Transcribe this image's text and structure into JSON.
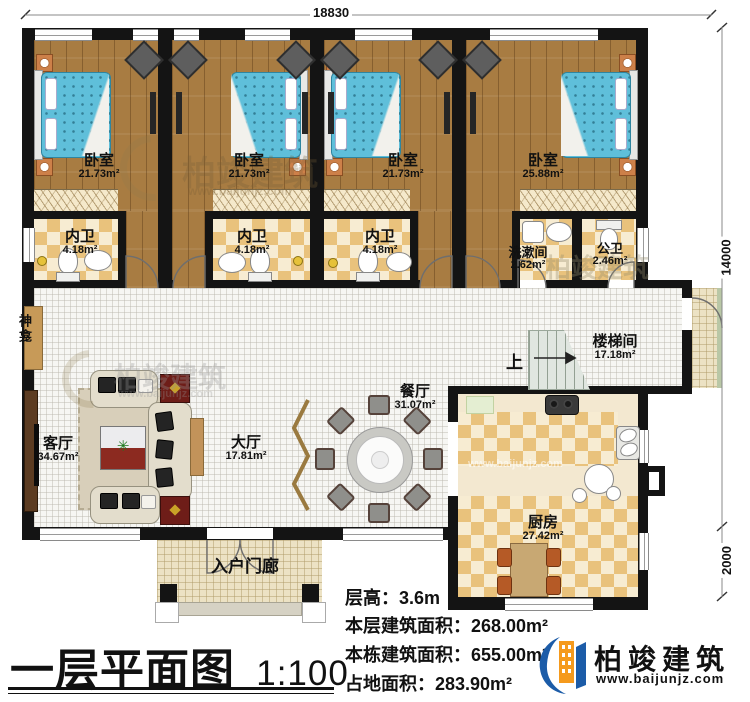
{
  "meta": {
    "title": "一层平面图",
    "scale": "1:100"
  },
  "dimensions": {
    "top_width": "18830",
    "right_height": "14000",
    "right_lower": "2000"
  },
  "rooms": [
    {
      "id": "bedroom1",
      "name": "卧室",
      "area": "21.73m²"
    },
    {
      "id": "bedroom2",
      "name": "卧室",
      "area": "21.73m²"
    },
    {
      "id": "bedroom3",
      "name": "卧室",
      "area": "21.73m²"
    },
    {
      "id": "bedroom4",
      "name": "卧室",
      "area": "25.88m²"
    },
    {
      "id": "ensuite1",
      "name": "内卫",
      "area": "4.18m²"
    },
    {
      "id": "ensuite2",
      "name": "内卫",
      "area": "4.18m²"
    },
    {
      "id": "ensuite3",
      "name": "内卫",
      "area": "4.18m²"
    },
    {
      "id": "washroom",
      "name": "洗漱间",
      "area": "2.62m²"
    },
    {
      "id": "public-bath",
      "name": "公卫",
      "area": "2.46m²"
    },
    {
      "id": "stairwell",
      "name": "楼梯间",
      "area": "17.18m²"
    },
    {
      "id": "dining",
      "name": "餐厅",
      "area": "31.07m²"
    },
    {
      "id": "hall",
      "name": "大厅",
      "area": "17.81m²"
    },
    {
      "id": "living",
      "name": "客厅",
      "area": "34.67m²"
    },
    {
      "id": "kitchen",
      "name": "厨房",
      "area": "27.42m²"
    },
    {
      "id": "porch",
      "name": "入户门廊",
      "area": ""
    }
  ],
  "labels": {
    "stairs_up": "上",
    "shrine": "神龛"
  },
  "info": {
    "floor_height_label": "层高：",
    "floor_height_value": "3.6m",
    "floor_area_label": "本层建筑面积：",
    "floor_area_value": "268.00m²",
    "building_area_label": "本栋建筑面积：",
    "building_area_value": "655.00m²",
    "footprint_label": "占地面积：",
    "footprint_value": "283.90m²"
  },
  "brand": {
    "name": "柏竣建筑",
    "website": "www.baijunjz.com",
    "blue": "#1c5ca8",
    "orange": "#f59a1d"
  },
  "watermark": {
    "text": "柏竣建筑",
    "sub": "www.baijunjz.com"
  }
}
